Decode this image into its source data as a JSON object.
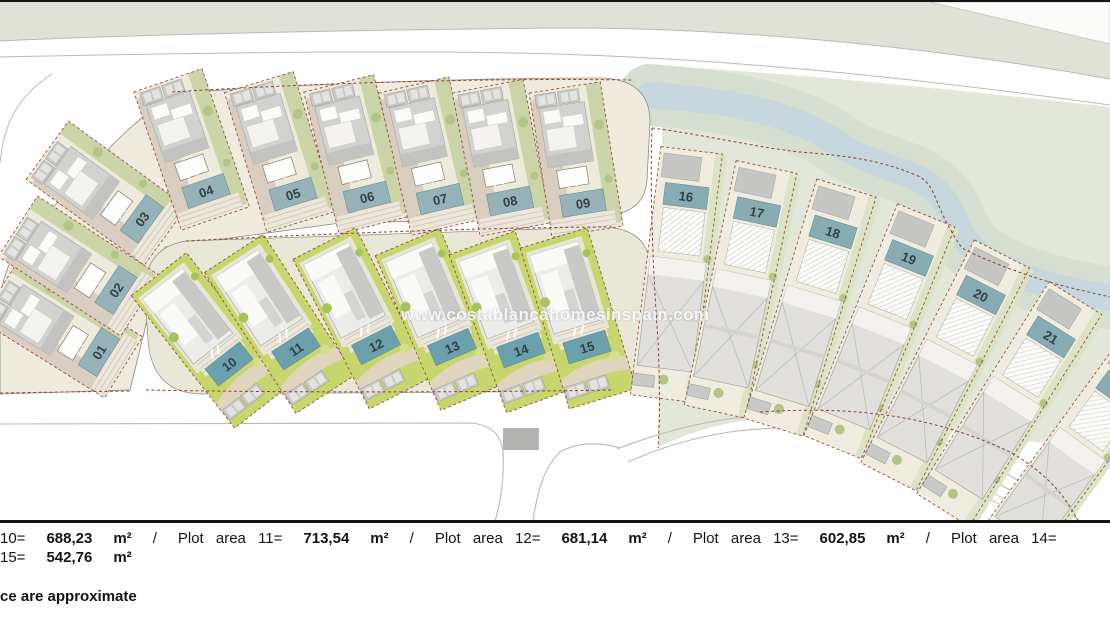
{
  "watermark": {
    "text": "www.costablancahomesinspain.com"
  },
  "colors": {
    "label_upper": "#96b3ba",
    "label_lower": "#6aa1ad",
    "label_right": "#87acb4",
    "label_text": "#333f44",
    "boundary_dash": "#8a4335",
    "top_band": "#e0e2d8",
    "terrain": "#e3e7d9",
    "river": "#c6d7dd",
    "river_bank": "#d7dfd2",
    "grass_bright": "#c7d76d",
    "plot_beige": "#f0ecdf",
    "road_line": "#b9b9b4"
  },
  "plots": [
    {
      "id": "01",
      "label": "01",
      "group": "left",
      "x": 99,
      "y": 352,
      "rot": -58
    },
    {
      "id": "02",
      "label": "02",
      "group": "left",
      "x": 116,
      "y": 290,
      "rot": -57
    },
    {
      "id": "03",
      "label": "03",
      "group": "left",
      "x": 142,
      "y": 219,
      "rot": -54
    },
    {
      "id": "04",
      "label": "04",
      "group": "upper",
      "x": 206,
      "y": 191,
      "rot": -19
    },
    {
      "id": "05",
      "label": "05",
      "group": "upper",
      "x": 293,
      "y": 194,
      "rot": -17
    },
    {
      "id": "06",
      "label": "06",
      "group": "upper",
      "x": 367,
      "y": 197,
      "rot": -14
    },
    {
      "id": "07",
      "label": "07",
      "group": "upper",
      "x": 440,
      "y": 199,
      "rot": -13
    },
    {
      "id": "08",
      "label": "08",
      "group": "upper",
      "x": 510,
      "y": 201,
      "rot": -11
    },
    {
      "id": "09",
      "label": "09",
      "group": "upper",
      "x": 583,
      "y": 203,
      "rot": -9
    },
    {
      "id": "10",
      "label": "10",
      "group": "lower",
      "x": 229,
      "y": 364,
      "rot": -38
    },
    {
      "id": "11",
      "label": "11",
      "group": "lower",
      "x": 296,
      "y": 349,
      "rot": -33
    },
    {
      "id": "12",
      "label": "12",
      "group": "lower",
      "x": 376,
      "y": 345,
      "rot": -27
    },
    {
      "id": "13",
      "label": "13",
      "group": "lower",
      "x": 452,
      "y": 347,
      "rot": -23
    },
    {
      "id": "14",
      "label": "14",
      "group": "lower",
      "x": 521,
      "y": 350,
      "rot": -20
    },
    {
      "id": "15",
      "label": "15",
      "group": "lower",
      "x": 587,
      "y": 347,
      "rot": -17
    },
    {
      "id": "16",
      "label": "16",
      "group": "right",
      "x": 686,
      "y": 196,
      "rot": 7
    },
    {
      "id": "17",
      "label": "17",
      "group": "right",
      "x": 757,
      "y": 212,
      "rot": 12
    },
    {
      "id": "18",
      "label": "18",
      "group": "right",
      "x": 833,
      "y": 232,
      "rot": 17
    },
    {
      "id": "19",
      "label": "19",
      "group": "right",
      "x": 909,
      "y": 258,
      "rot": 22
    },
    {
      "id": "20",
      "label": "20",
      "group": "right",
      "x": 981,
      "y": 295,
      "rot": 27
    },
    {
      "id": "21",
      "label": "21",
      "group": "right",
      "x": 1051,
      "y": 337,
      "rot": 32
    },
    {
      "id": "edge",
      "label": "",
      "group": "right",
      "x": 1120,
      "y": 392,
      "rot": 36
    }
  ],
  "footer": {
    "line1": [
      {
        "text": "10=",
        "bold": false
      },
      {
        "text": "688,23",
        "bold": true
      },
      {
        "text": "m²",
        "bold": true
      },
      {
        "text": "/",
        "bold": false
      },
      {
        "text": "Plot area 11=",
        "bold": false
      },
      {
        "text": "713,54",
        "bold": true
      },
      {
        "text": "m²",
        "bold": true
      },
      {
        "text": "/",
        "bold": false
      },
      {
        "text": "Plot area 12=",
        "bold": false
      },
      {
        "text": "681,14",
        "bold": true
      },
      {
        "text": "m²",
        "bold": true
      },
      {
        "text": "/",
        "bold": false
      },
      {
        "text": "Plot area 13=",
        "bold": false
      },
      {
        "text": "602,85",
        "bold": true
      },
      {
        "text": "m²",
        "bold": true
      },
      {
        "text": "/",
        "bold": false
      },
      {
        "text": "Plot area 14=",
        "bold": false
      }
    ],
    "line2": [
      {
        "text": "15=",
        "bold": false
      },
      {
        "text": "542,76",
        "bold": true
      },
      {
        "text": "m²",
        "bold": true
      }
    ],
    "note": "ce are approximate"
  }
}
